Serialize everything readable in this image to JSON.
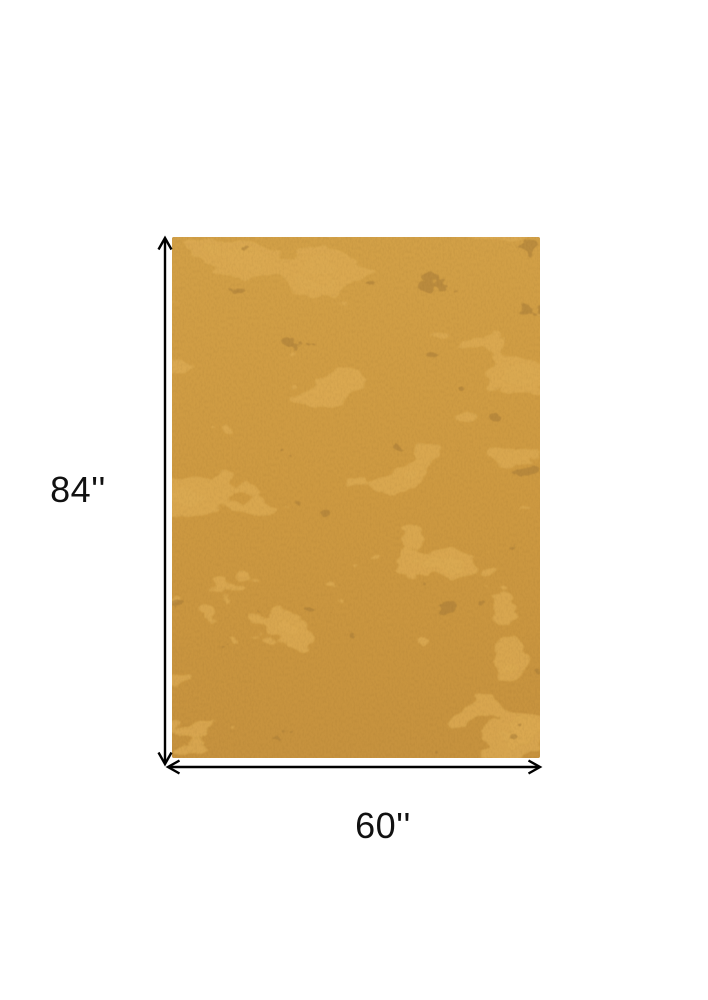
{
  "diagram": {
    "height_label": "84''",
    "width_label": "60''",
    "rug_alt": "gold distressed abstract textured rectangular area rug",
    "colors": {
      "background": "#ffffff",
      "label_text": "#111111",
      "dimension_line": "#000000",
      "rug_base": "#cd9941",
      "rug_base_top": "#d2a047",
      "rug_base_bottom": "#c6923e",
      "rug_light": "#dcab53",
      "rug_dark": "#a87c37",
      "rug_edge": "#6e4d1c"
    }
  }
}
